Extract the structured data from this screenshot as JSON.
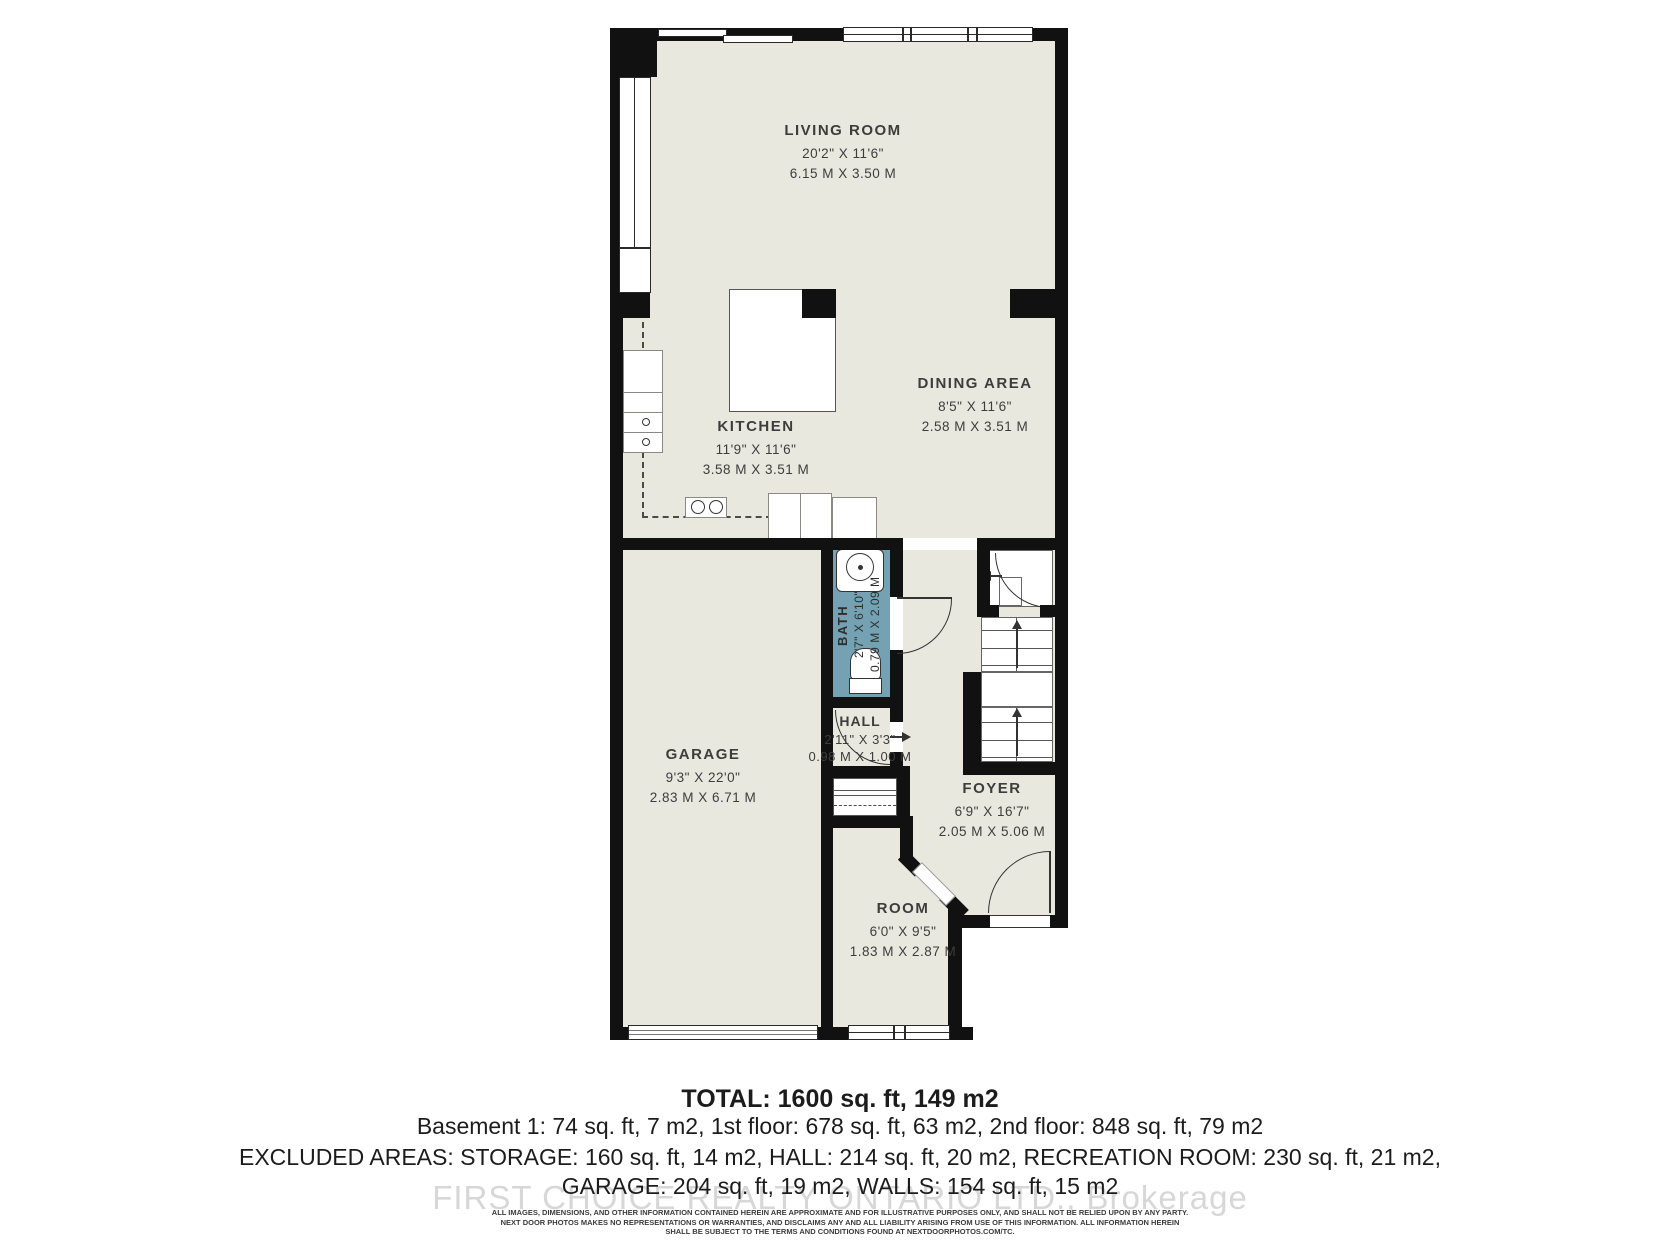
{
  "plan": {
    "rooms": [
      {
        "id": "living-room",
        "name": "LIVING ROOM",
        "dims_ft": "20'2\" X 11'6\"",
        "dims_m": "6.15 M X 3.50 M"
      },
      {
        "id": "kitchen",
        "name": "KITCHEN",
        "dims_ft": "11'9\" X 11'6\"",
        "dims_m": "3.58 M X 3.51 M"
      },
      {
        "id": "dining-area",
        "name": "DINING AREA",
        "dims_ft": "8'5\" X 11'6\"",
        "dims_m": "2.58 M X 3.51 M"
      },
      {
        "id": "garage",
        "name": "GARAGE",
        "dims_ft": "9'3\" X 22'0\"",
        "dims_m": "2.83 M X 6.71 M"
      },
      {
        "id": "bath",
        "name": "BATH",
        "dims_ft": "2'7\" X 6'10\"",
        "dims_m": "0.79 M X 2.09 M"
      },
      {
        "id": "hall",
        "name": "HALL",
        "dims_ft": "2'11\" X 3'3\"",
        "dims_m": "0.98 M X 1.00 M"
      },
      {
        "id": "foyer",
        "name": "FOYER",
        "dims_ft": "6'9\" X 16'7\"",
        "dims_m": "2.05 M X 5.06 M"
      },
      {
        "id": "room",
        "name": "ROOM",
        "dims_ft": "6'0\" X 9'5\"",
        "dims_m": "1.83 M X 2.87 M"
      }
    ],
    "colors": {
      "floor": "#e9e8de",
      "wall": "#111111",
      "bath": "#74a2b2"
    }
  },
  "summary": {
    "total": "TOTAL: 1600 sq. ft, 149 m2",
    "floors": "Basement 1: 74 sq. ft, 7 m2, 1st floor: 678 sq. ft, 63 m2, 2nd floor: 848 sq. ft, 79 m2",
    "excluded1": "EXCLUDED AREAS: STORAGE: 160 sq. ft, 14 m2, HALL: 214 sq. ft, 20 m2, RECREATION ROOM: 230 sq. ft, 21 m2,",
    "excluded2": "GARAGE: 204 sq. ft, 19 m2, WALLS: 154 sq. ft, 15 m2"
  },
  "watermark": "FIRST CHOICE REALTY ONTARIO LTD., Brokerage",
  "disclaimer": {
    "line1": "ALL IMAGES, DIMENSIONS, AND OTHER INFORMATION CONTAINED HEREIN ARE APPROXIMATE AND FOR ILLUSTRATIVE PURPOSES ONLY, AND SHALL NOT BE RELIED UPON BY ANY PARTY.",
    "line2": "NEXT DOOR PHOTOS MAKES NO REPRESENTATIONS OR WARRANTIES, AND DISCLAIMS ANY AND ALL LIABILITY ARISING FROM USE OF THIS INFORMATION. ALL INFORMATION HEREIN",
    "line3": "SHALL BE SUBJECT TO THE TERMS AND CONDITIONS FOUND AT NEXTDOORPHOTOS.COM/TC."
  }
}
